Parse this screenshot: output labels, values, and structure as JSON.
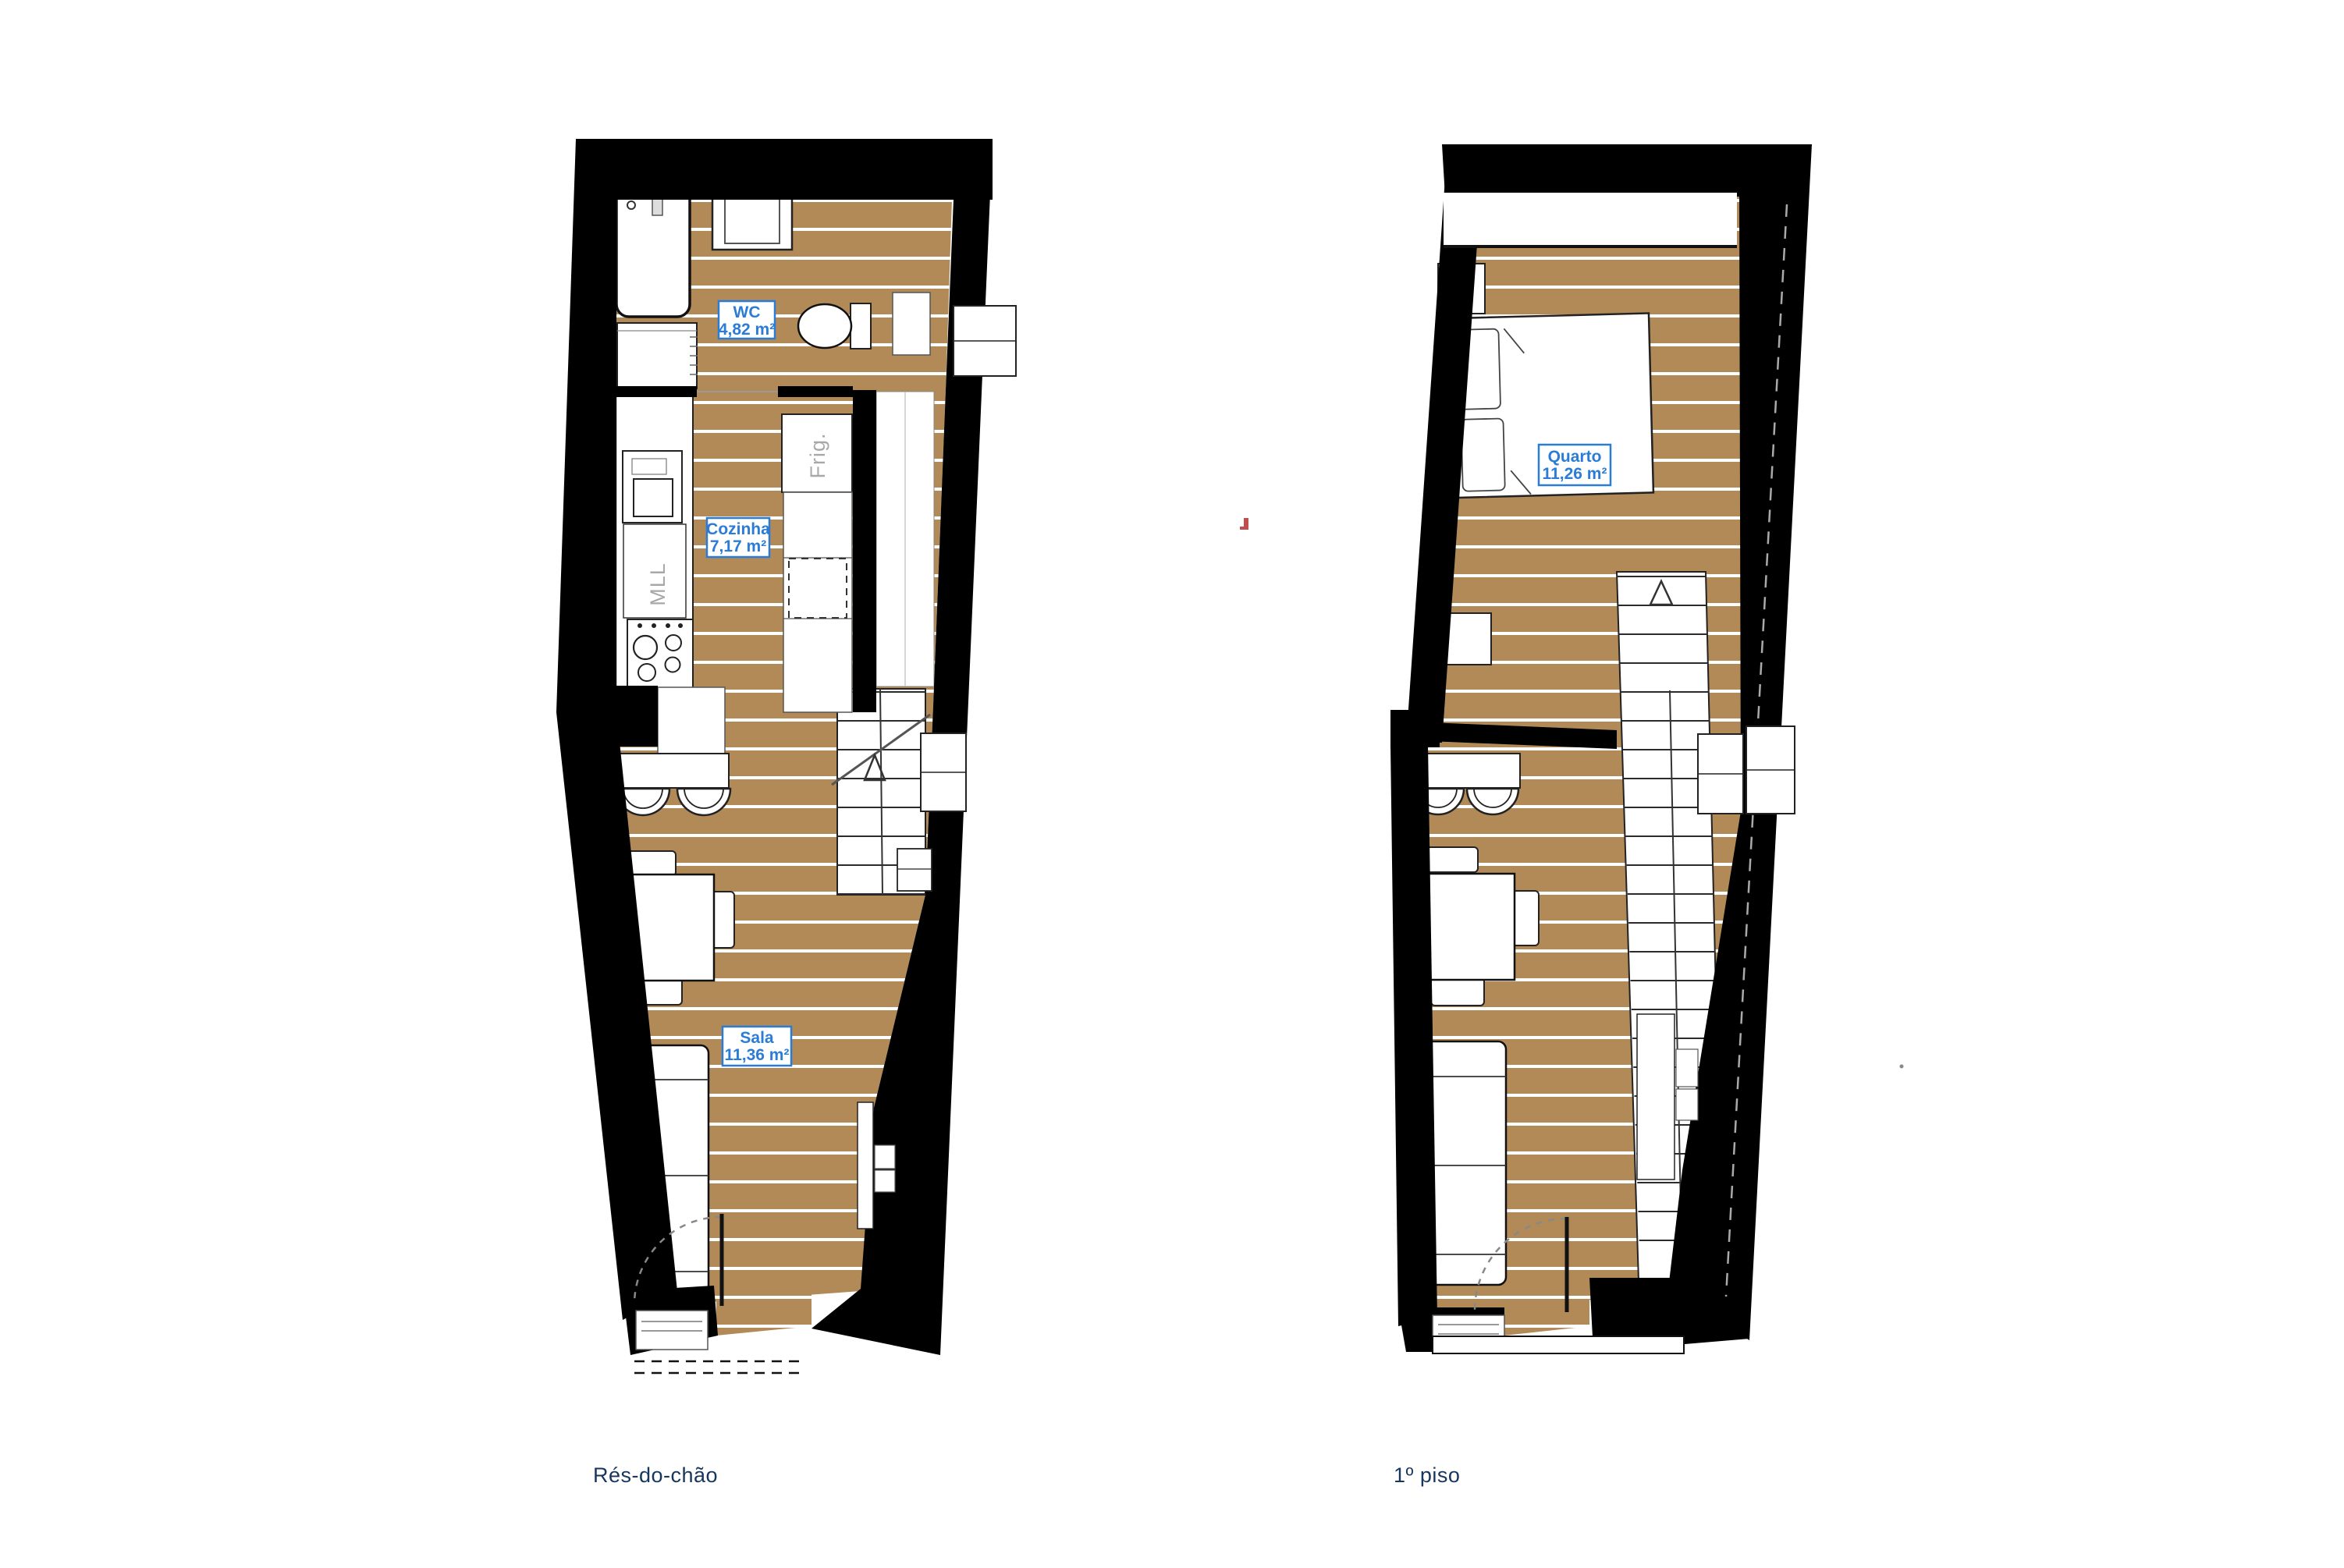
{
  "colors": {
    "background": "#ffffff",
    "wall_black": "#000000",
    "wood_brown": "#B18A58",
    "plank_line": "#ffffff",
    "label_blue": "#2A7CD6",
    "caption_navy": "#17365D",
    "appliance_gray": "#A8A8A8",
    "red_mark": "#C0504D"
  },
  "floors": [
    {
      "caption": "Rés-do-chão",
      "rooms": [
        {
          "name": "WC",
          "area": "4,82 m²"
        },
        {
          "name": "Cozinha",
          "area": "7,17 m²"
        },
        {
          "name": "Sala",
          "area": "11,36 m²"
        }
      ],
      "appliances": {
        "fridge": "Frig.",
        "dishwasher": "MLL"
      }
    },
    {
      "caption": "1º piso",
      "rooms": [
        {
          "name": "Quarto",
          "area": "11,26 m²"
        }
      ]
    }
  ]
}
